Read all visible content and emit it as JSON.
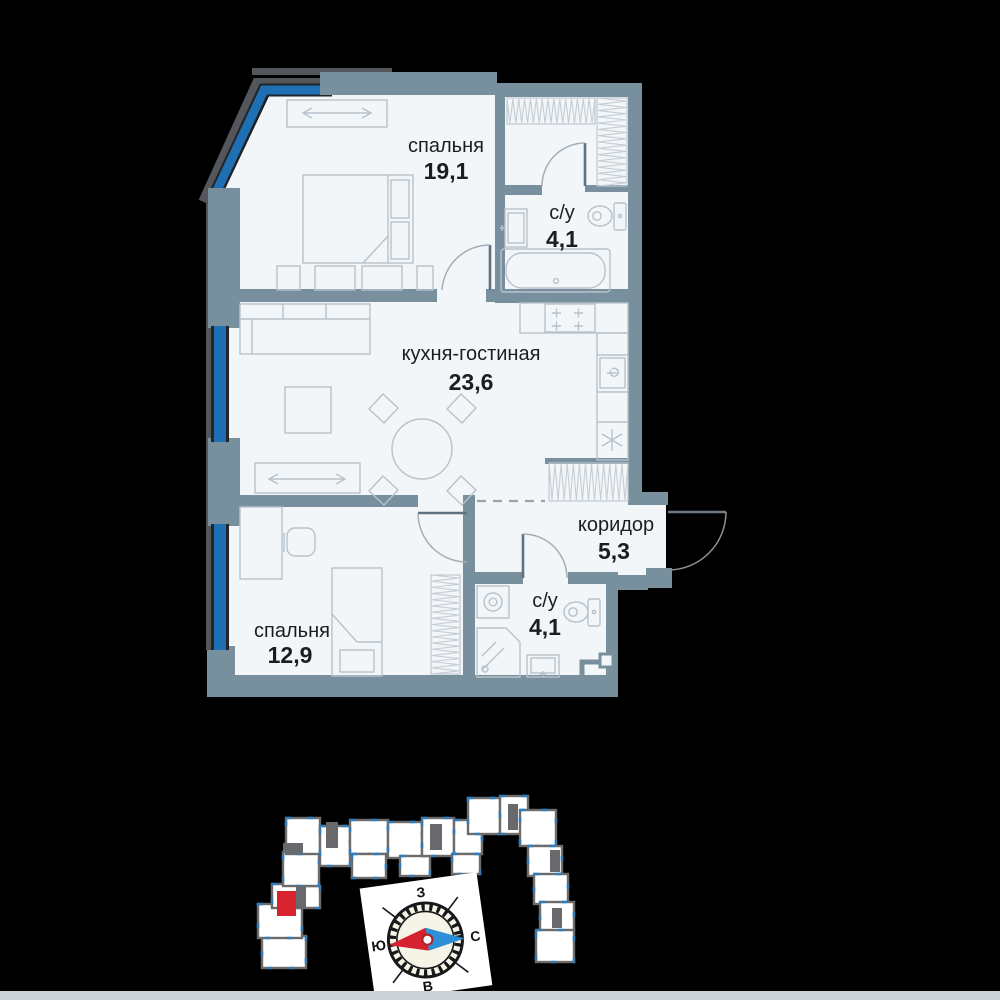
{
  "floor_plan": {
    "rooms": [
      {
        "name": "спальня",
        "area": "19,1"
      },
      {
        "name": "с/у",
        "area": "4,1"
      },
      {
        "name": "кухня-гостиная",
        "area": "23,6"
      },
      {
        "name": "коридор",
        "area": "5,3"
      },
      {
        "name": "спальня",
        "area": "12,9"
      },
      {
        "name": "с/у",
        "area": "4,1"
      }
    ]
  },
  "compass": {
    "top": "З",
    "left": "Ю",
    "right": "С",
    "bottom": "В"
  },
  "colors": {
    "wall": "#78909d",
    "floor": "#f2f6f9",
    "window_blue": "#1f6fb5",
    "furniture_line": "#b7c2cb",
    "text": "#1b1e21",
    "unit_fill": "#ffffff",
    "unit_stroke": "#6c6c6c",
    "core_fill": "#67696c",
    "window_tick": "#2f7dbf",
    "highlight_red": "#d8232f",
    "needle_red": "#d6222e",
    "needle_blue": "#2d8fd5",
    "compass_face": "#f6f3e7",
    "bottom_strip": "#ccd1d6"
  },
  "site_plan": {
    "highlight": [
      277,
      891,
      19,
      25
    ],
    "units": [
      [
        262,
        936,
        44,
        32
      ],
      [
        258,
        904,
        44,
        34
      ],
      [
        272,
        884,
        30,
        24
      ],
      [
        298,
        886,
        22,
        22
      ],
      [
        283,
        852,
        36,
        34
      ],
      [
        286,
        818,
        34,
        36
      ],
      [
        320,
        826,
        30,
        40
      ],
      [
        350,
        820,
        38,
        34
      ],
      [
        352,
        854,
        34,
        24
      ],
      [
        388,
        822,
        34,
        36
      ],
      [
        400,
        856,
        30,
        20
      ],
      [
        422,
        818,
        32,
        38
      ],
      [
        454,
        820,
        28,
        34
      ],
      [
        452,
        854,
        28,
        20
      ],
      [
        468,
        798,
        32,
        36
      ],
      [
        500,
        796,
        28,
        38
      ],
      [
        520,
        810,
        36,
        36
      ],
      [
        528,
        846,
        34,
        30
      ],
      [
        534,
        874,
        34,
        30
      ],
      [
        540,
        902,
        34,
        30
      ],
      [
        536,
        930,
        38,
        32
      ]
    ],
    "cores": [
      [
        326,
        822,
        12,
        26
      ],
      [
        430,
        824,
        12,
        26
      ],
      [
        508,
        804,
        10,
        26
      ],
      [
        296,
        886,
        10,
        22
      ],
      [
        550,
        850,
        10,
        22
      ],
      [
        552,
        908,
        10,
        20
      ],
      [
        283,
        843,
        20,
        10
      ]
    ]
  }
}
